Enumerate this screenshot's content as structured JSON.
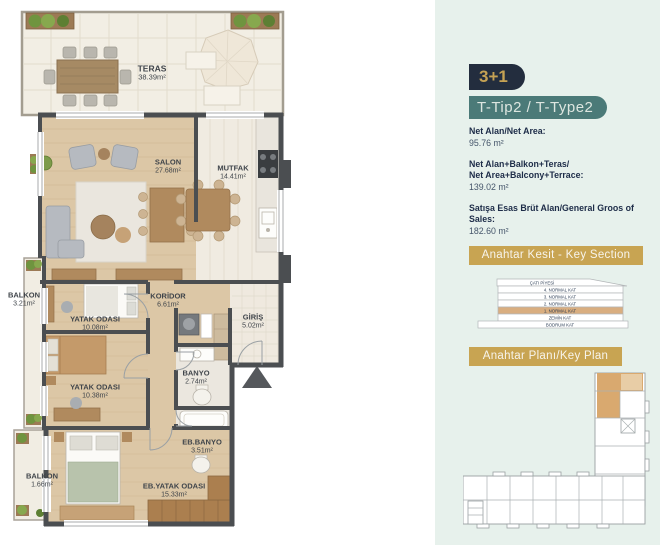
{
  "floor_plan": {
    "rooms": [
      {
        "name": "TERAS",
        "area": "38.39m²"
      },
      {
        "name": "SALON",
        "area": "27.68m²"
      },
      {
        "name": "MUTFAK",
        "area": "14.41m²"
      },
      {
        "name": "BALKON",
        "area": "3.21m²"
      },
      {
        "name": "KORİDOR",
        "area": "6.61m²"
      },
      {
        "name": "YATAK ODASI",
        "area": "10.08m²"
      },
      {
        "name": "GİRİŞ",
        "area": "5.02m²"
      },
      {
        "name": "YATAK ODASI",
        "area": "10.38m²"
      },
      {
        "name": "BANYO",
        "area": "2.74m²"
      },
      {
        "name": "EB.BANYO",
        "area": "3.51m²"
      },
      {
        "name": "EB.YATAK ODASI",
        "area": "15.33m²"
      },
      {
        "name": "BALKON",
        "area": "1.66m²"
      }
    ]
  },
  "panel": {
    "unit_type": "3+1",
    "type_label": "T-Tip2 / T-Type2",
    "stats": [
      {
        "line1": "Net Alan/Net Area:",
        "line2": "",
        "value": "95.76 m²"
      },
      {
        "line1": "Net Alan+Balkon+Teras/",
        "line2": "Net Area+Balcony+Terrace:",
        "value": "139.02 m²"
      },
      {
        "line1": "Satışa Esas Brüt Alan/General Groos of Sales:",
        "line2": "",
        "value": "182.60 m²"
      }
    ],
    "key_section": {
      "title": "Anahtar Kesit - Key Section",
      "floors": [
        "ÇATI PİYESİ",
        "4. NORMAL KAT",
        "3. NORMAL KAT",
        "2. NORMAL KAT",
        "1. NORMAL KAT",
        "ZEMİN KAT",
        "BODRUM KAT"
      ],
      "highlighted_floor": "1. NORMAL KAT"
    },
    "key_plan": {
      "title": "Anahtar Planı/Key Plan"
    }
  },
  "colors": {
    "panel_bg": "#e7f1ec",
    "badge_navy": "#232d3e",
    "badge_gold_text": "#c5a254",
    "badge_teal": "#4b7a78",
    "banner_gold": "#c8a452",
    "highlight_tan": "#d9ae80",
    "wall_gray": "#4b4e51",
    "wood_floor": "#dcc7a6"
  }
}
